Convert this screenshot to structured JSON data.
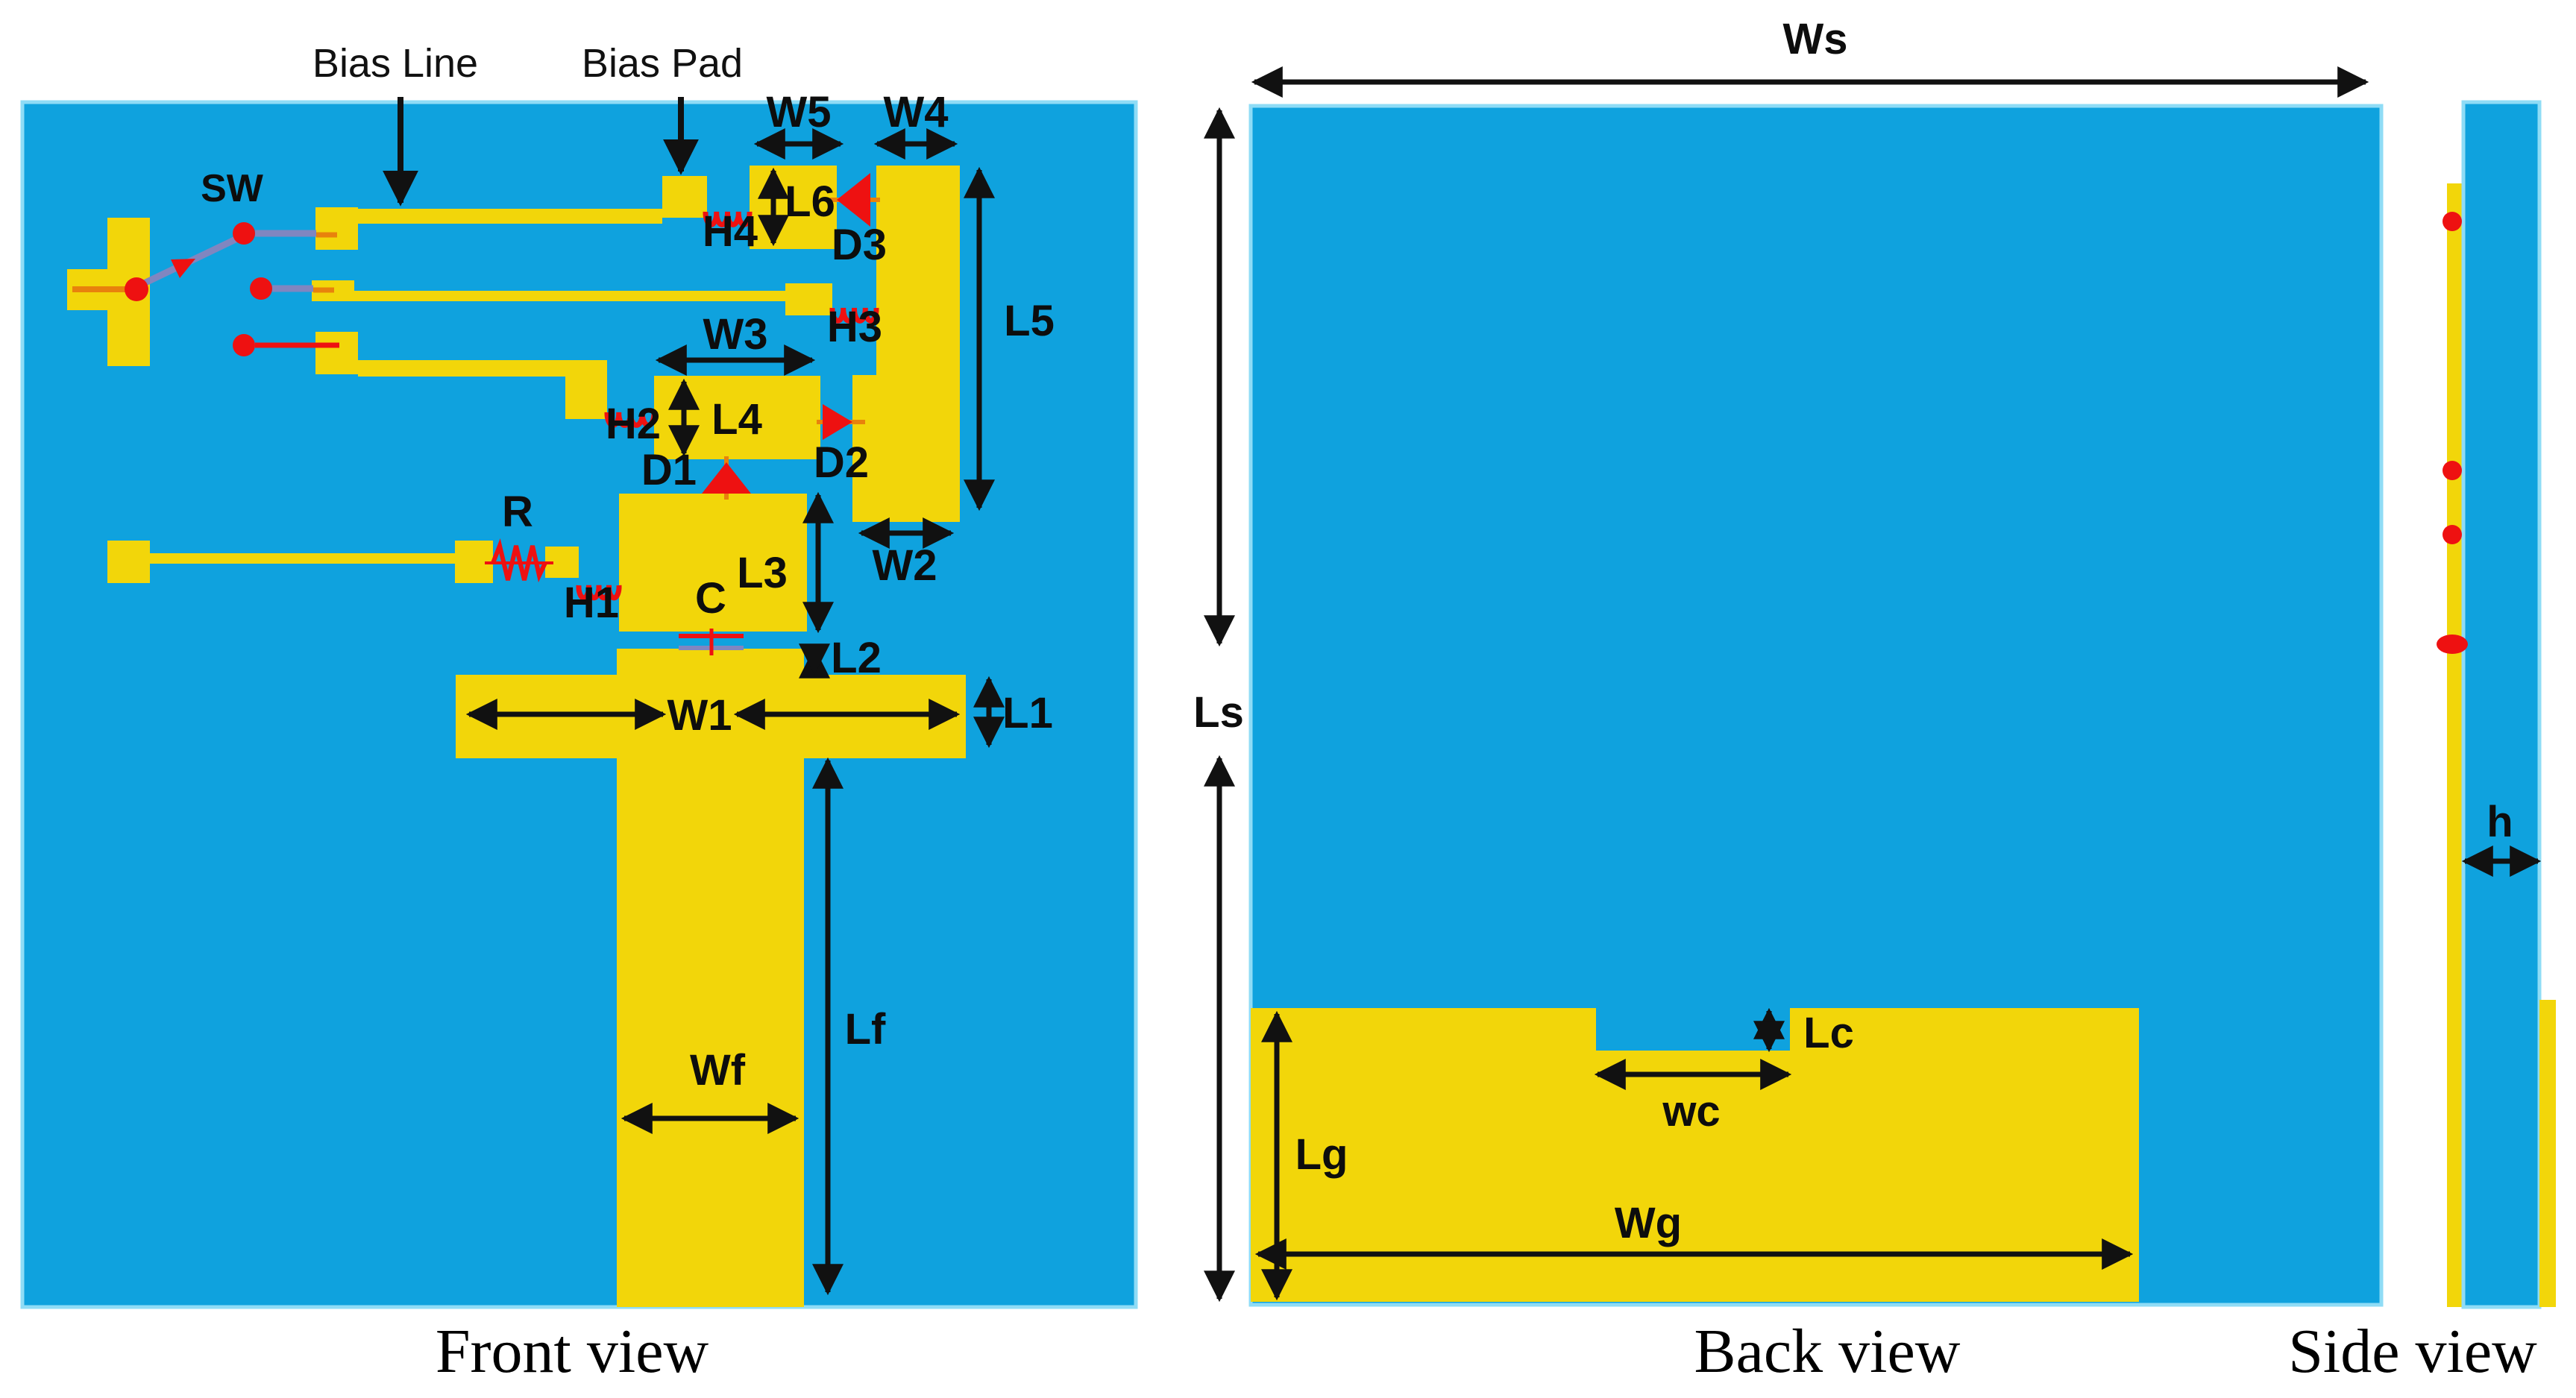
{
  "colors": {
    "substrate": "#0FA2DE",
    "substrate_edge": "#8FDCF6",
    "copper": "#F2D60A",
    "component_red": "#EE1111",
    "wire_orange": "#E8820C",
    "wire_slate": "#8086C0",
    "annotation": "#111111",
    "background": "#FFFFFF"
  },
  "front_view": {
    "caption": "Front view",
    "component_labels": {
      "bias_line": "Bias Line",
      "bias_pad": "Bias Pad",
      "sw": "SW",
      "r": "R",
      "c": "C",
      "h1": "H1",
      "h2": "H2",
      "h3": "H3",
      "h4": "H4",
      "d1": "D1",
      "d2": "D2",
      "d3": "D3"
    },
    "dimension_labels": {
      "w1": "W1",
      "w2": "W2",
      "w3": "W3",
      "w4": "W4",
      "w5": "W5",
      "l1": "L1",
      "l2": "L2",
      "l3": "L3",
      "l4": "L4",
      "l5": "L5",
      "l6": "L6",
      "lf": "Lf",
      "wf": "Wf"
    }
  },
  "back_view": {
    "caption": "Back view",
    "dimension_labels": {
      "ws": "Ws",
      "ls": "Ls",
      "lg": "Lg",
      "wg": "Wg",
      "lc": "Lc",
      "wc": "wc"
    }
  },
  "side_view": {
    "caption": "Side view",
    "dimension_labels": {
      "h": "h"
    }
  }
}
